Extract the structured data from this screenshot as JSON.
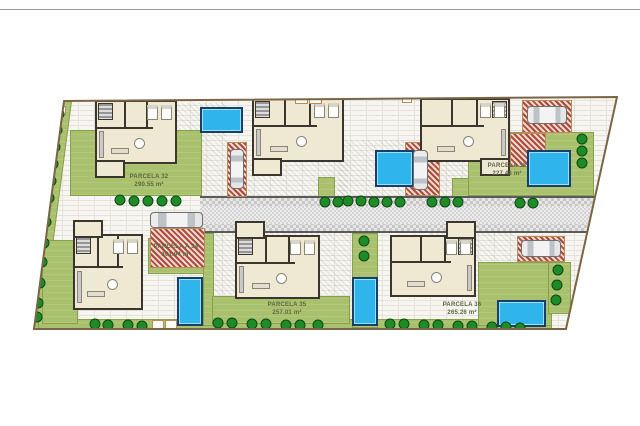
{
  "document": {
    "kind": "architectural site plan",
    "title": ""
  },
  "plan": {
    "border_color": "#7a6647",
    "garden_color": "#a9c06c",
    "pool_color": "#2fb5ec",
    "driveway_color": "#b0493c",
    "road_color": "#c7c7c7",
    "tree_color": "#1f8a28",
    "parcels": [
      {
        "id": "parcela-32",
        "name": "PARCELA 32",
        "area": "290.55 m²"
      },
      {
        "id": "parcela-33",
        "name": "PARCELA 33",
        "area": "227.48 m²"
      },
      {
        "id": "parcela-a34",
        "name": "PARCELA A 34",
        "area": "301.94 m²"
      },
      {
        "id": "parcela-35",
        "name": "PARCELA 35",
        "area": "257.01 m²"
      },
      {
        "id": "parcela-36",
        "name": "PARCELA 36",
        "area": "265.26 m²"
      }
    ]
  }
}
